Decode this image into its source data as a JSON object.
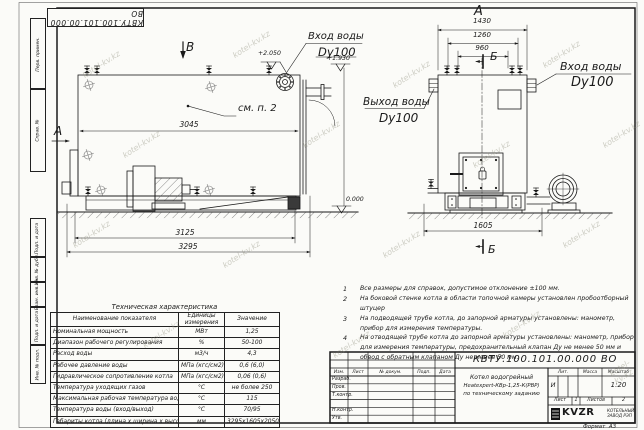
{
  "sheet": {
    "corner_stamp": "КВТУ.100.101.00.000 ВО",
    "watermark": "kotel-kv.kz",
    "format_label": "Формат",
    "format_value": "А3",
    "margin_labels": [
      "Перв. примен.",
      "Справ. №",
      "Подп. и дата",
      "Инв. № дубл.",
      "Взам. инв. №",
      "Подп. и дата",
      "Инв. № подл."
    ]
  },
  "side_view": {
    "view_top": "В",
    "view_left": "А",
    "callout": "см. п. 2",
    "dim_body": "3045",
    "dim_frame": "3125",
    "dim_overall": "3295",
    "elev_top": "+2.050",
    "elev_outlet": "+1.930",
    "elev_ground": "0.000",
    "inlet_label": "Вход воды",
    "inlet_size": "Dy100"
  },
  "front_view": {
    "view_title": "А",
    "dim_overall": "1430",
    "dim_flanges": "1260",
    "dim_vents": "960",
    "section_top": "Б",
    "section_bottom": "Б",
    "dim_depth": "1605",
    "inlet_label": "Вход воды",
    "inlet_size": "Dy100",
    "outlet_label": "Выход воды",
    "outlet_size": "Dy100"
  },
  "notes": [
    {
      "num": "1",
      "text": "Все размеры для справок, допустимое отклонение ±100 мм."
    },
    {
      "num": "2",
      "text": "На боковой стенке котла в области топочной камеры установлен пробоотборный штуцер"
    },
    {
      "num": "3",
      "text": "На подводящей трубе котла, до запорной арматуры установлены: манометр, прибор для измерения температуры."
    },
    {
      "num": "4",
      "text": "На отводящей трубе котла до запорной арматуры установлены: манометр, прибор для измерения температуры, предохранительный клапан Ду не менее 50 мм и обвод с обратным клапаном Ду не менее 50 мм."
    }
  ],
  "spec_table": {
    "title": "Техническая характеристика",
    "col_name": "Наименование показателя",
    "col_units": "Единицы измерения",
    "col_value": "Значение",
    "rows": [
      {
        "name": "Номинальная мощность",
        "units": "МВт",
        "value": "1,25"
      },
      {
        "name": "Диапазон рабочего регулирования",
        "units": "%",
        "value": "50-100"
      },
      {
        "name": "Расход воды",
        "units": "м3/ч",
        "value": "4,3"
      },
      {
        "name": "Рабочее давление воды",
        "units": "МПа (кгс/см2)",
        "value": "0,6 (6,0)"
      },
      {
        "name": "Гидравлическое сопротивление котла",
        "units": "МПа (кгс/см2)",
        "value": "0,06 (0,6)"
      },
      {
        "name": "Температура уходящих газов",
        "units": "°С",
        "value": "не более 250"
      },
      {
        "name": "Максимальная рабочая температура воды",
        "units": "°С",
        "value": "115"
      },
      {
        "name": "Температура воды (вход/выход)",
        "units": "°С",
        "value": "70/95"
      },
      {
        "name": "Габариты котла (длина х ширина х высота)",
        "units": "мм",
        "value": "3295х1605х2050"
      }
    ]
  },
  "title_block": {
    "doc_number": "КВТУ.100.101.00.000 ВО",
    "rev_headers": [
      "Изм.",
      "Лист",
      "№ докум.",
      "Подп.",
      "Дата"
    ],
    "sign_rows": [
      "Разраб.",
      "Пров.",
      "Т.контр.",
      "",
      "Н.контр.",
      "Утв."
    ],
    "product_lines": [
      "Котел водогрейный",
      "Heatexpert-КВр-1,25-К(РВР)",
      "по техническому заданию"
    ],
    "lit_label": "Лит.",
    "mass_label": "Масса",
    "scale_label": "Масштаб",
    "lit_value": "И",
    "scale_value": "1:20",
    "sheet_label": "Лист",
    "sheet_value": "1",
    "sheets_label": "Листов",
    "sheets_value": "2",
    "logo_text": "KVZR",
    "company": "КОТЕЛЬНЫЙ ЗАВОД РЭП"
  }
}
